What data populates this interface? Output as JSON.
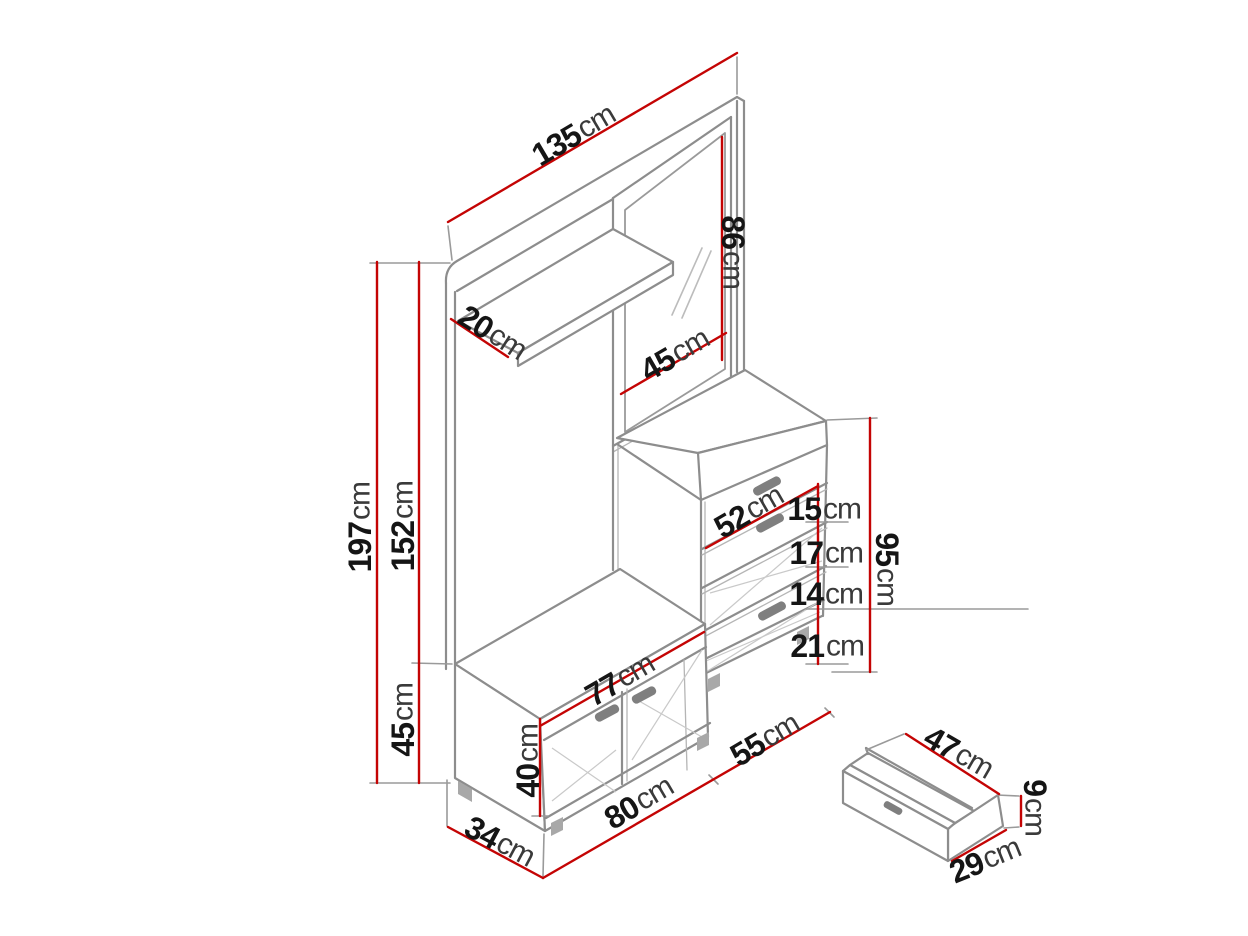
{
  "diagram": {
    "type": "furniture-dimension-drawing",
    "subject": "hallway wardrobe set with mirror, shelf, shoe cabinet, bench and detail drawer",
    "unit": "cm"
  },
  "labels": {
    "width_total": {
      "value": "135",
      "unit": "cm"
    },
    "mirror_height": {
      "value": "86",
      "unit": "cm"
    },
    "shelf_depth": {
      "value": "20",
      "unit": "cm"
    },
    "mirror_width": {
      "value": "45",
      "unit": "cm"
    },
    "height_total": {
      "value": "197",
      "unit": "cm"
    },
    "height_panel": {
      "value": "152",
      "unit": "cm"
    },
    "bench_section_height": {
      "value": "45",
      "unit": "cm"
    },
    "cabinet_width": {
      "value": "52",
      "unit": "cm"
    },
    "drawer1_height": {
      "value": "15",
      "unit": "cm"
    },
    "drawer2_height": {
      "value": "17",
      "unit": "cm"
    },
    "drawer3_height": {
      "value": "14",
      "unit": "cm"
    },
    "drawer4_height": {
      "value": "21",
      "unit": "cm"
    },
    "cabinet_height": {
      "value": "95",
      "unit": "cm"
    },
    "bench_inner_width": {
      "value": "77",
      "unit": "cm"
    },
    "bench_height": {
      "value": "40",
      "unit": "cm"
    },
    "bench_width": {
      "value": "80",
      "unit": "cm"
    },
    "cabinet_front_width": {
      "value": "55",
      "unit": "cm"
    },
    "depth": {
      "value": "34",
      "unit": "cm"
    },
    "drawer_box_width": {
      "value": "47",
      "unit": "cm"
    },
    "drawer_box_height": {
      "value": "9",
      "unit": "cm"
    },
    "drawer_box_depth": {
      "value": "29",
      "unit": "cm"
    }
  },
  "colors": {
    "dimension_line": "#c40404",
    "outline": "#8d8d8d",
    "text": "#151515",
    "background": "#ffffff"
  }
}
